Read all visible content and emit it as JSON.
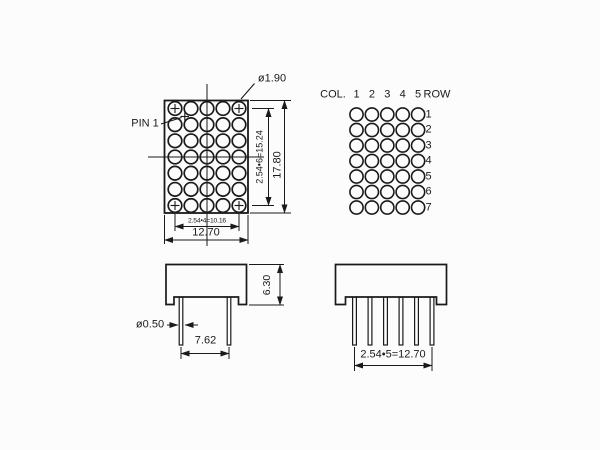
{
  "drawing": {
    "ink_color": "#1a1a1a",
    "background_color": "#fcfcfc",
    "description": "5x7 LED dot matrix display package outline drawing"
  },
  "front_view": {
    "pin1_label": "PIN 1",
    "dot_diameter_label": "ø1.90",
    "dim_row_pitch": "2.54•6=15.24",
    "dim_height": "17.80",
    "dim_col_pitch": "2.54•4=10.16",
    "dim_width": "12.70",
    "grid": {
      "rows": 7,
      "cols": 5
    }
  },
  "pin_grid": {
    "col_label": "COL.",
    "row_label": "ROW",
    "col_numbers": [
      "1",
      "2",
      "3",
      "4",
      "5"
    ],
    "row_numbers": [
      "1",
      "2",
      "3",
      "4",
      "5",
      "6",
      "7"
    ],
    "grid": {
      "rows": 7,
      "cols": 5
    }
  },
  "side_view_front": {
    "dim_body_height": "6.30",
    "dim_pin_diameter": "ø0.50",
    "dim_pin_spacing": "7.62",
    "pin_count": 2
  },
  "side_view_side": {
    "dim_pin_pitch": "2.54•5=12.70",
    "pin_count": 6
  }
}
